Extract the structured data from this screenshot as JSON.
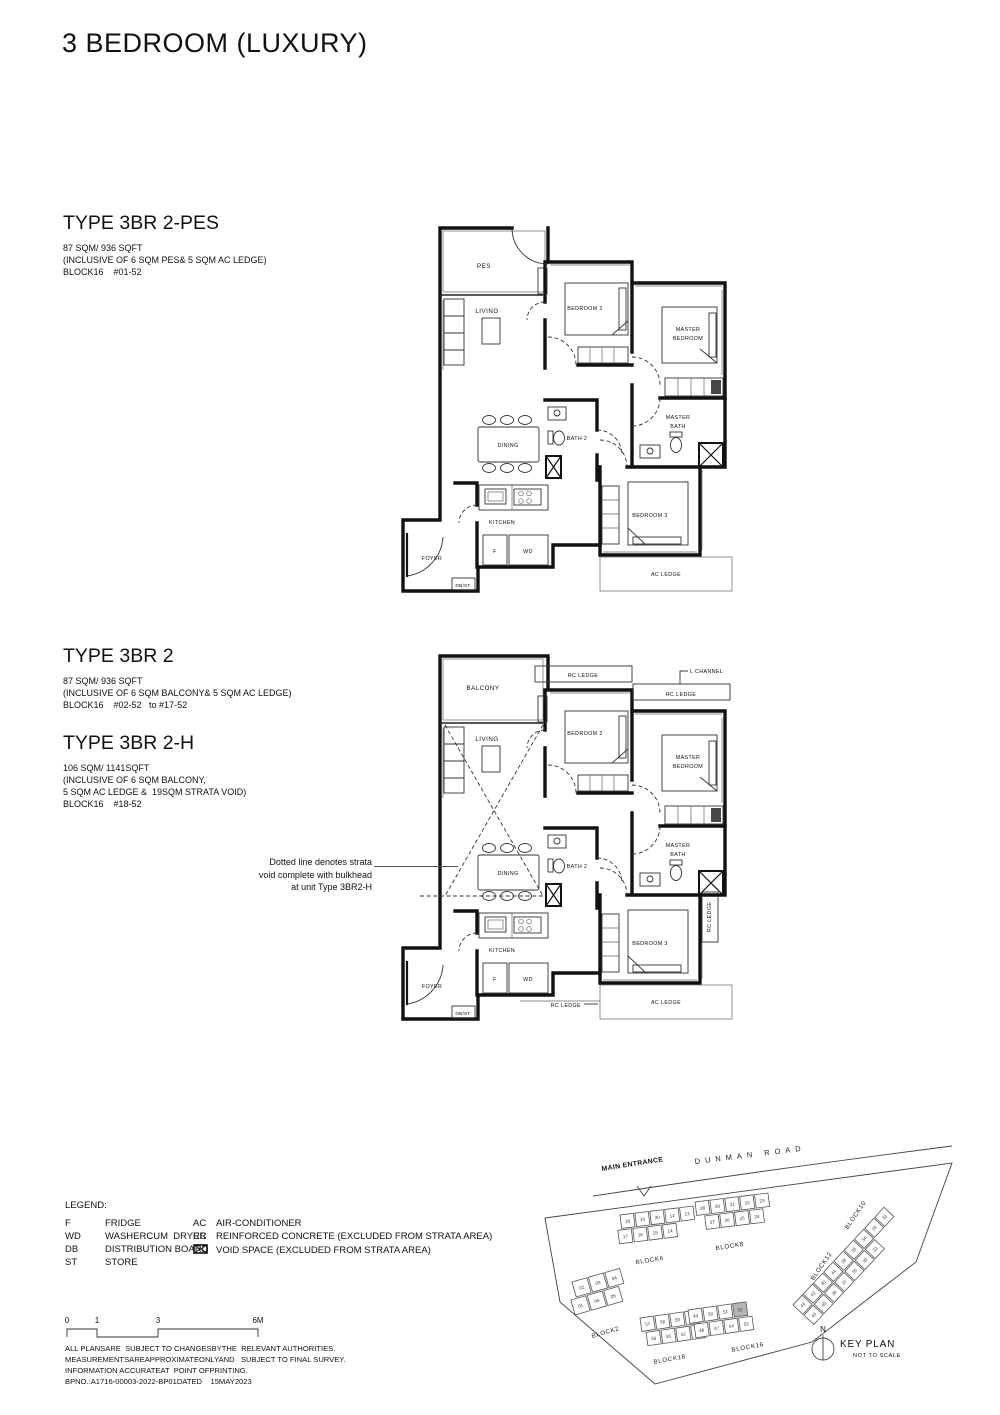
{
  "title": "3 BEDROOM (LUXURY)",
  "types": [
    {
      "name": "TYPE 3BR 2-PES",
      "details": [
        "87 SQM/ 936 SQFT",
        "(INCLUSIVE OF 6 SQM PES& 5 SQM AC LEDGE)",
        "BLOCK16    #01-52"
      ]
    },
    {
      "name": "TYPE 3BR 2",
      "details": [
        "87 SQM/ 936 SQFT",
        "(INCLUSIVE OF 6 SQM BALCONY& 5 SQM AC LEDGE)",
        "BLOCK16    #02-52   to #17-52"
      ]
    },
    {
      "name": "TYPE 3BR 2-H",
      "details": [
        "106 SQM/ 1141SQFT",
        "(INCLUSIVE OF 6 SQM BALCONY,",
        "5 SQM AC LEDGE &  19SQM STRATA VOID)",
        "BLOCK16    #18-52"
      ]
    }
  ],
  "annotation": {
    "lines": [
      "Dotted line denotes strata",
      "void complete with bulkhead",
      "at unit Type 3BR2-H"
    ]
  },
  "plan1": {
    "labels": {
      "pes": "PES",
      "living": "LIVING",
      "bedroom2": "BEDROOM 2",
      "master1": "MASTER",
      "master2": "BEDROOM",
      "mbath1": "MASTER",
      "mbath2": "BATH",
      "bath2": "BATH 2",
      "dining": "DINING",
      "kitchen": "KITCHEN",
      "f": "F",
      "wd": "WD",
      "foyer": "FOYER",
      "dbst": "DB/ST",
      "bedroom3": "BEDROOM 3",
      "ac_ledge": "AC LEDGE"
    }
  },
  "plan2": {
    "labels": {
      "balcony": "BALCONY",
      "living": "LIVING",
      "rc_top": "RC LEDGE",
      "l_channel": "L CHANNEL",
      "rc_top2": "RC LEDGE",
      "bedroom2": "BEDROOM 2",
      "master1": "MASTER",
      "master2": "BEDROOM",
      "mbath1": "MASTER",
      "mbath2": "BATH",
      "bath2": "BATH 2",
      "dining": "DINING",
      "kitchen": "KITCHEN",
      "f": "F",
      "wd": "WD",
      "foyer": "FOYER",
      "dbst": "DB/ST",
      "bedroom3": "BEDROOM 3",
      "ac_ledge": "AC LEDGE",
      "rc_right": "RC LEDGE",
      "rc_bottom": "RC LEDGE"
    }
  },
  "legend": {
    "title": "LEGEND:",
    "left": [
      {
        "abbr": "F",
        "desc": "FRIDGE"
      },
      {
        "abbr": "WD",
        "desc": "WASHERCUM  DRYER"
      },
      {
        "abbr": "DB",
        "desc": "DISTRIBUTION BOARD"
      },
      {
        "abbr": "ST",
        "desc": "STORE"
      }
    ],
    "right": [
      {
        "abbr": "AC",
        "desc": "AIR-CONDITIONER"
      },
      {
        "abbr": "RC",
        "desc": "REINFORCED CONCRETE (EXCLUDED FROM STRATA AREA)"
      },
      {
        "abbr": "",
        "icon": "void-box",
        "desc": "VOID SPACE (EXCLUDED FROM STRATA AREA)"
      }
    ]
  },
  "scalebar": {
    "labels": [
      "0",
      "1",
      "3",
      "6M"
    ]
  },
  "disclaimer": {
    "lines": [
      "ALL PLANSARE  SUBJECT TO CHANGESBYTHE  RELEVANT AUTHORITIES.",
      "MEASUREMENTSAREAPPROXIMATEONLYAND   SUBJECT TO FINAL SURVEY.",
      "INFORMATION ACCURATEAT  POINT OFPRINTING.",
      "BPNO.:A1716-00003-2022-BP01DATED    15MAY2023"
    ]
  },
  "keyplan": {
    "main_entrance": "MAIN ENTRANCE",
    "road": "DUNMAN ROAD",
    "north": "N",
    "title": "KEY PLAN",
    "subtitle": "NOT TO SCALE",
    "highlighted_unit": "52",
    "highlight_color": "#b5b5b5",
    "blocks": {
      "b6": {
        "name": "BLOCK6",
        "rows": [
          [
            "18",
            "19",
            "20",
            "12",
            "13"
          ],
          [
            "17",
            "16",
            "15",
            "14"
          ]
        ]
      },
      "b8": {
        "name": "BLOCK8",
        "rows": [
          [
            "28",
            "29",
            "21",
            "22",
            "23"
          ],
          [
            "27",
            "26",
            "25",
            "24"
          ]
        ]
      },
      "b2": {
        "name": "BLOCK2",
        "rows": [
          [
            "02",
            "03",
            "04"
          ],
          [
            "01",
            "06",
            "05"
          ]
        ]
      },
      "b18": {
        "name": "BLOCK18",
        "rows": [
          [
            "57",
            "58",
            "59",
            "60"
          ],
          [
            "56",
            "55",
            "62",
            "61"
          ]
        ]
      },
      "b16": {
        "name": "BLOCK16",
        "rows": [
          [
            "49",
            "50",
            "51",
            "52"
          ],
          [
            "48",
            "47",
            "54",
            "53"
          ]
        ]
      },
      "b10": {
        "name": "BLOCK10"
      },
      "b12": {
        "name": "BLOCK12",
        "rows": [
          [
            "44",
            "42",
            "40",
            "41",
            "38",
            "36",
            "34",
            "31",
            "32"
          ],
          [
            "43",
            "45",
            "39",
            "37",
            "35",
            "30",
            "33"
          ]
        ]
      }
    }
  }
}
